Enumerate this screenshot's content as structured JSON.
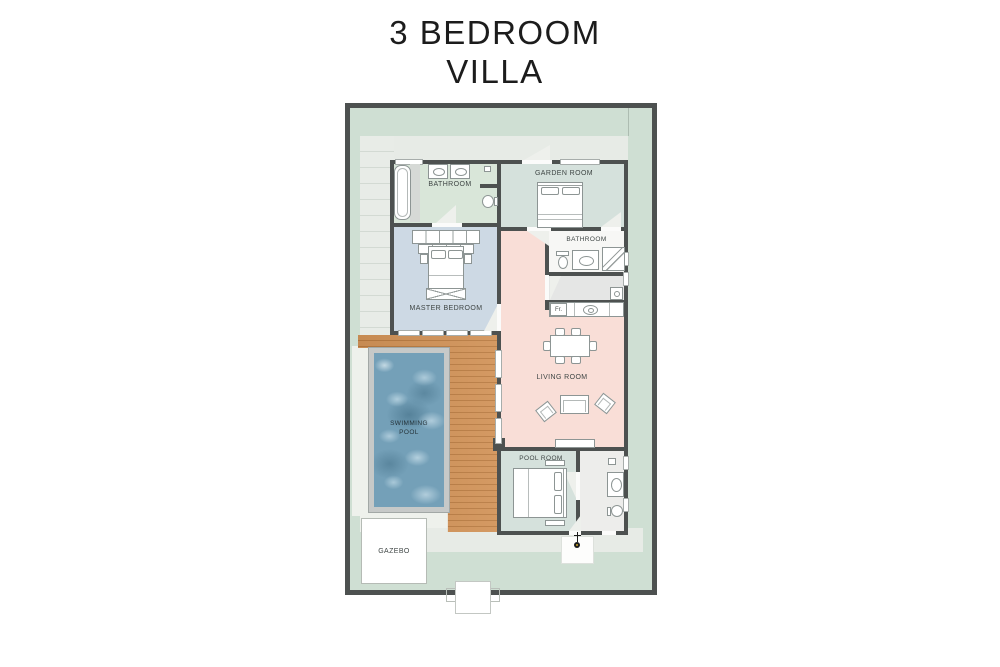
{
  "title": {
    "line1": "3 BEDROOM",
    "line2": "VILLA"
  },
  "labels": {
    "bathroom_top": "BATHROOM",
    "garden_room": "GARDEN ROOM",
    "bathroom_right": "BATHROOM",
    "master_bedroom": "MASTER BEDROOM",
    "living_room": "LIVING ROOM",
    "swimming_pool_line1": "SWIMMING",
    "swimming_pool_line2": "POOL",
    "pool_room": "POOL ROOM",
    "gazebo": "GAZEBO",
    "fridge": "Fr."
  },
  "colors": {
    "wall": "#4d5150",
    "site_green": "#cfdfd3",
    "paved": "#e7ebe6",
    "bathroom_floor": "#d9e6d9",
    "garden_room_floor": "#d5e1dc",
    "master_floor": "#cdd9e4",
    "living_floor": "#f9ded7",
    "pool_room_floor": "#d5e1dc",
    "utility_floor": "#e5e6e5",
    "deck": "#c8854b",
    "pool_water": "#74a0b8",
    "pool_coping": "#c6c9c8"
  }
}
